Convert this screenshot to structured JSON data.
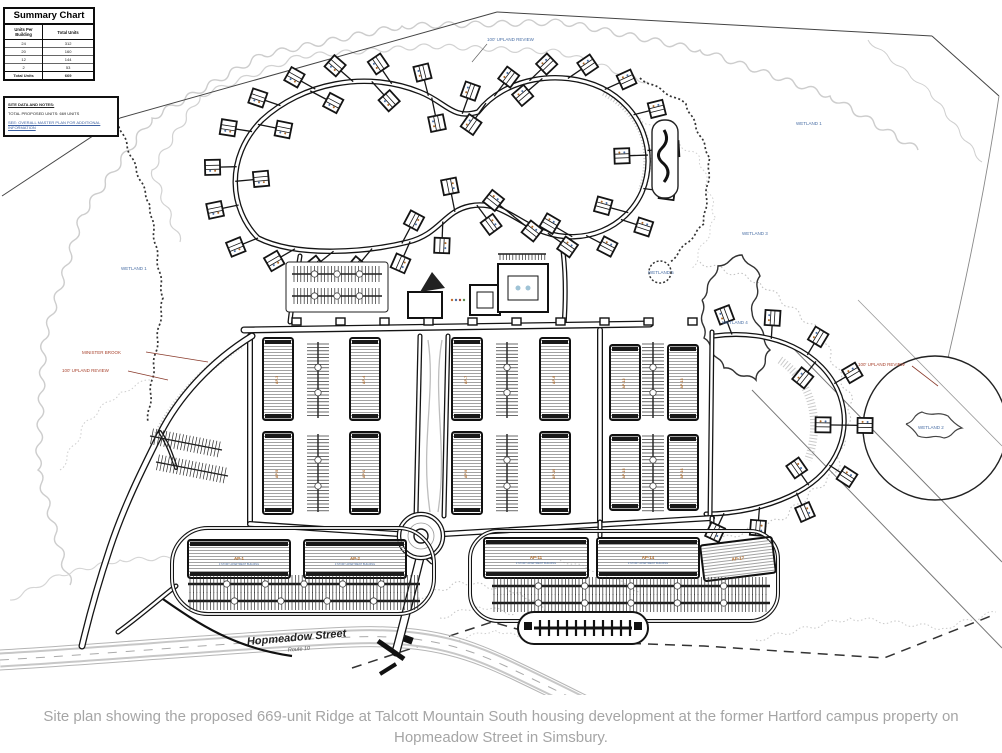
{
  "caption": "Site plan showing the proposed 669-unit Ridge at Talcott Mountain South housing development at the former Hartford campus property on Hopmeadow Street in Simsbury.",
  "summary_chart": {
    "title": "Summary Chart",
    "col_units_per_building": "Units Per Building",
    "col_total_units": "Total Units",
    "rows": [
      [
        "24",
        "312"
      ],
      [
        "20",
        "160"
      ],
      [
        "12",
        "144"
      ],
      [
        "2",
        "53"
      ]
    ],
    "total_label": "Total Units",
    "total_value": "669"
  },
  "notes": {
    "lines": [
      "SITE DATA AND NOTES:",
      "TOTAL PROPOSED UNITS: 669 UNITS",
      "SEE: OVERALL MASTER PLAN FOR ADDITIONAL INFORMATION"
    ]
  },
  "map_labels": {
    "street_name": "Hopmeadow Street",
    "street_route": "Route 10",
    "wetland_1_west": "WETLAND 1",
    "wetland_1_east": "WETLAND 1",
    "wetland_2": "WETLAND 2",
    "wetland_3": "WETLAND 3",
    "wetland_4": "WETLAND 4",
    "wetland_5": "WETLAND 5",
    "upland_review_north": "100' UPLAND REVIEW",
    "upland_review_west": "100' UPLAND REVIEW",
    "upland_review_east": "100' UPLAND REVIEW",
    "minister_brook": "MINISTER BROOK"
  },
  "building_labels": {
    "central": [
      "AP-3",
      "AP-4",
      "AP-5",
      "AP-6",
      "AP-7",
      "AP-8",
      "AP-9",
      "AP-10",
      "AP-12",
      "AP-13",
      "AP-15",
      "AP-16"
    ],
    "bottom_left": [
      "AP-1",
      "AP-2"
    ],
    "bottom_right": [
      "AP-11",
      "AP-14",
      "AP-17"
    ],
    "bottom_sub": "3 STORY APARTMENT BUILDING"
  },
  "colors": {
    "label_blue": "#4a6fa5",
    "label_red": "#a8432e",
    "linework": "#141414",
    "contour_gray": "#cdcdcd",
    "caption_gray": "#a5a5a5",
    "unit_orange": "#b06a28"
  }
}
